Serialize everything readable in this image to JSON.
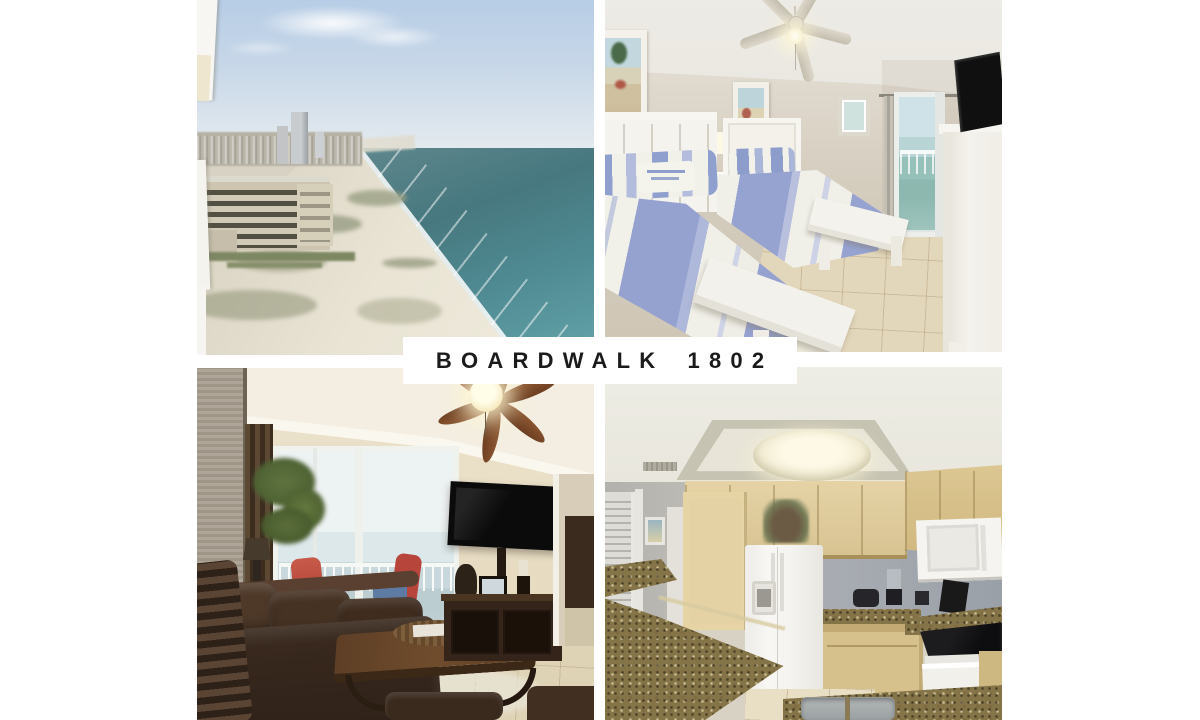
{
  "page": {
    "background": "#ffffff"
  },
  "banner": {
    "label": "BOARDWALK 1802",
    "background": "#ffffff",
    "text_color": "#1b1b1b"
  },
  "collage": {
    "grid": "2x2",
    "gutter_color": "#ffffff",
    "photos": [
      {
        "id": "aerial-beach-view",
        "position": "top-left",
        "description": "Aerial view of a white-sand gulf beach coastline with condo towers, city and turquoise surf",
        "palette": {
          "sky": "#bdd1e6",
          "water": "#4e828b",
          "sand": "#e9e4d5",
          "buildings": "#cbc3ad"
        }
      },
      {
        "id": "bedroom-two-beds",
        "position": "top-right",
        "description": "Bedroom with two white beds in blue striped bedding, ceiling fan, lamp, beach art and gulf-view door",
        "palette": {
          "walls": "#d6cfc0",
          "bedding_blue": "#95a2d0",
          "bedding_white": "#f0efe8",
          "tile_floor": "#e2d6ba"
        }
      },
      {
        "id": "living-room",
        "position": "bottom-left",
        "description": "Living room with brown leather sofa, wood coffee table, wall-mounted TV and balcony doors with ocean view",
        "palette": {
          "walls": "#e9dfc7",
          "leather": "#3a2a1e",
          "wood": "#5e3f26",
          "view": "#ccdadd"
        }
      },
      {
        "id": "kitchen",
        "position": "bottom-right",
        "description": "Kitchen with light maple cabinets, granite counters, white refrigerator, microwave and range",
        "palette": {
          "cabinets": "#e0cc9c",
          "granite": "#857447",
          "appliances": "#f5f4f0",
          "wall": "#a9adb3"
        }
      }
    ]
  }
}
